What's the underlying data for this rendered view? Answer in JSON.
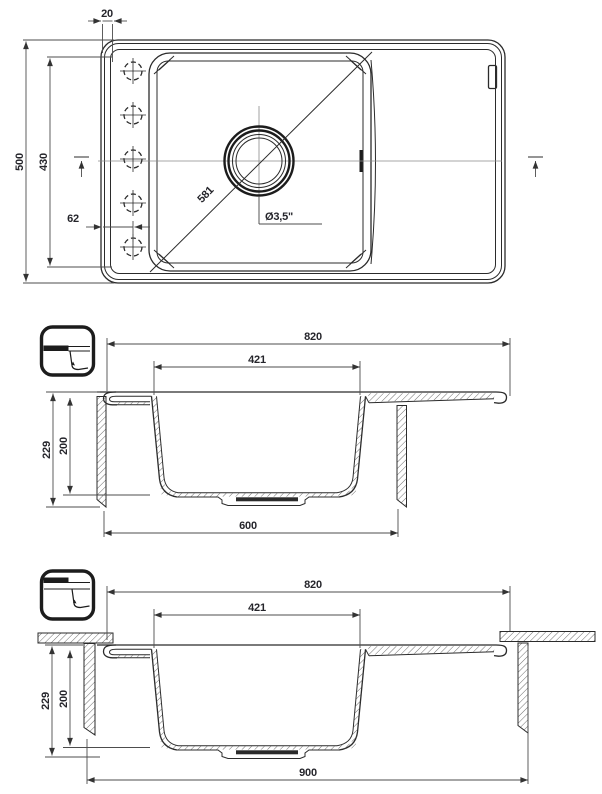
{
  "page": {
    "background": "#ffffff"
  },
  "colors": {
    "line": "#2b2b2b",
    "dim_line": "#4d4d4d",
    "text": "#25252b"
  },
  "top_view": {
    "dimensions": {
      "rim_width": "20",
      "overall_depth": "500",
      "inner_depth": "430",
      "tap_hole_offset": "62",
      "bowl_diagonal": "581",
      "drain_size": "Ø3,5\""
    }
  },
  "flush_section": {
    "dimensions": {
      "overall_width": "820",
      "bowl_top_width": "421",
      "overall_height": "229",
      "bowl_depth": "200",
      "cabinet_width": "600"
    }
  },
  "under_section": {
    "dimensions": {
      "overall_width": "820",
      "bowl_top_width": "421",
      "overall_height": "229",
      "bowl_depth": "200",
      "worktop_width": "900"
    }
  }
}
